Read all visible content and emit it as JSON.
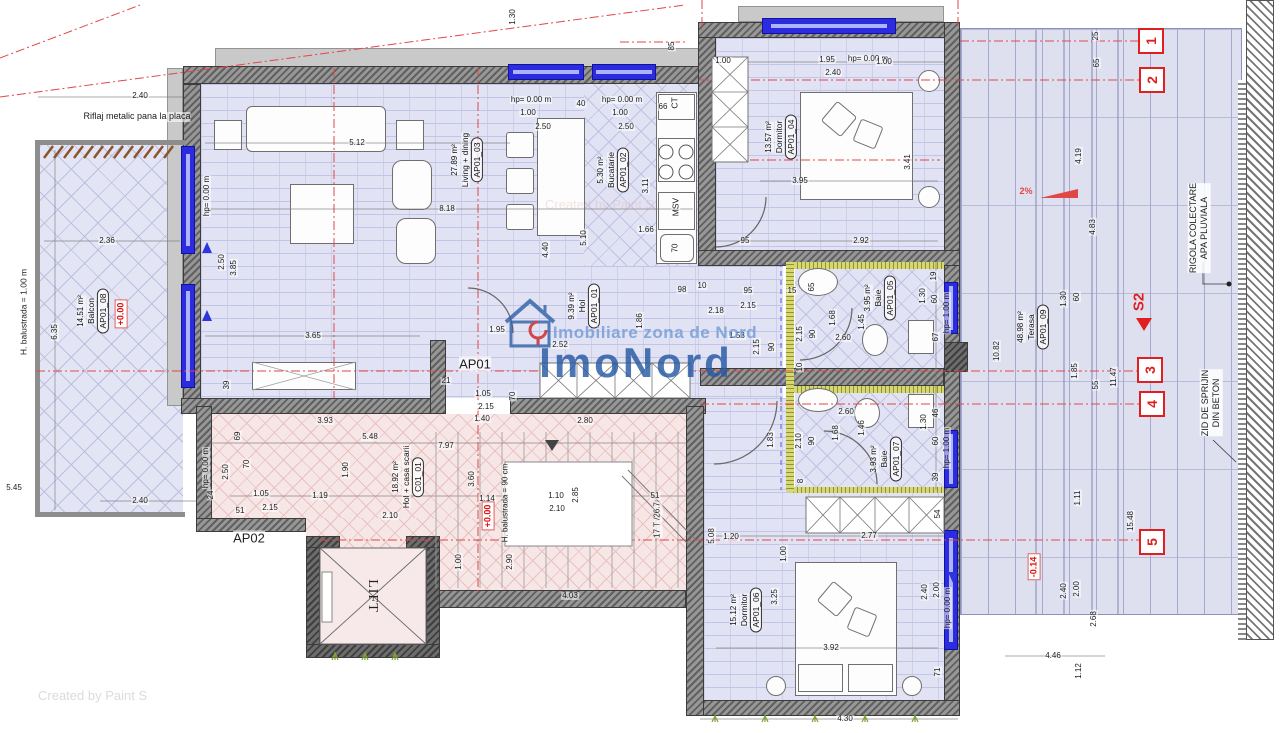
{
  "watermark": {
    "subtitle": "Imobiliare zona de Nord",
    "brand": "ImoNord",
    "credit": "Created by Paint S"
  },
  "unit_labels": {
    "ap01": "AP01",
    "ap02": "AP02",
    "lift": "LIFT"
  },
  "equipment": {
    "ct": "CT",
    "msv": "MSV",
    "sink": "70",
    "stairs_note": "17 T /26.7"
  },
  "notes": {
    "riflaj": "Riflaj metalic pana la placa",
    "balustrade_balcony": "H. balustrada = 1.00 m",
    "balustrade_stairs": "H. balustrada = 90 cm",
    "rigola_line1": "RIGOLA COLECTARE",
    "rigola_line2": "APA PLUVIALA",
    "zid_line1": "ZID DE SPRIJIN",
    "zid_line2": "DIN BETON",
    "slope": "2%",
    "section": "S2"
  },
  "levels": [
    {
      "t": "+0.00",
      "x": 121,
      "y": 314
    },
    {
      "t": "+0.00",
      "x": 488,
      "y": 516
    },
    {
      "t": "-0.14",
      "x": 1034,
      "y": 567
    }
  ],
  "grid_markers": [
    {
      "n": "1",
      "x": 1151,
      "y": 41
    },
    {
      "n": "2",
      "x": 1152,
      "y": 80
    },
    {
      "n": "3",
      "x": 1150,
      "y": 370
    },
    {
      "n": "4",
      "x": 1152,
      "y": 404
    },
    {
      "n": "5",
      "x": 1152,
      "y": 542
    }
  ],
  "rooms": [
    {
      "id": "AP01_03",
      "name": "Living + dining",
      "area": "27.89 m²",
      "x": 467,
      "y": 160
    },
    {
      "id": "AP01_02",
      "name": "Bucatarie",
      "area": "5.30 m²",
      "x": 613,
      "y": 170
    },
    {
      "id": "AP01_04",
      "name": "Dormitor",
      "area": "13.57 m²",
      "x": 781,
      "y": 137
    },
    {
      "id": "AP01_01",
      "name": "Hol",
      "area": "9.39 m²",
      "x": 584,
      "y": 306
    },
    {
      "id": "AP01_05",
      "name": "Baie",
      "area": "3.95 m²",
      "x": 880,
      "y": 298
    },
    {
      "id": "AP01_07",
      "name": "Baie",
      "area": "3.93 m²",
      "x": 886,
      "y": 459
    },
    {
      "id": "AP01_06",
      "name": "Dormitor",
      "area": "15.12 m²",
      "x": 746,
      "y": 610
    },
    {
      "id": "AP01_08",
      "name": "Balcon",
      "area": "14.51 m²",
      "x": 93,
      "y": 311
    },
    {
      "id": "AP01_09",
      "name": "Terasa",
      "area": "48.98 m²",
      "x": 1033,
      "y": 327
    },
    {
      "id": "C01_01",
      "name": "Hol + casa scarii",
      "area": "18.92 m²",
      "x": 408,
      "y": 477
    }
  ],
  "dimensions": [
    {
      "t": "2.40",
      "x": 140,
      "y": 96
    },
    {
      "t": "5.12",
      "x": 357,
      "y": 143
    },
    {
      "t": "1.30",
      "x": 513,
      "y": 17,
      "v": 1
    },
    {
      "t": "hp= 0.00 m",
      "x": 531,
      "y": 100
    },
    {
      "t": "1.00",
      "x": 528,
      "y": 113
    },
    {
      "t": "2.50",
      "x": 543,
      "y": 127
    },
    {
      "t": "40",
      "x": 581,
      "y": 104
    },
    {
      "t": "hp= 0.00 m",
      "x": 622,
      "y": 100
    },
    {
      "t": "1.00",
      "x": 620,
      "y": 113
    },
    {
      "t": "2.50",
      "x": 626,
      "y": 127
    },
    {
      "t": "66",
      "x": 663,
      "y": 107
    },
    {
      "t": "85",
      "x": 672,
      "y": 46,
      "v": 1
    },
    {
      "t": "1.00",
      "x": 723,
      "y": 61
    },
    {
      "t": "1.95",
      "x": 827,
      "y": 60
    },
    {
      "t": "hp= 0.00 m",
      "x": 868,
      "y": 59
    },
    {
      "t": "2.40",
      "x": 833,
      "y": 73
    },
    {
      "t": "1.00",
      "x": 884,
      "y": 62
    },
    {
      "t": "3.95",
      "x": 800,
      "y": 181
    },
    {
      "t": "3.41",
      "x": 908,
      "y": 162,
      "v": 1
    },
    {
      "t": "2.92",
      "x": 861,
      "y": 241
    },
    {
      "t": "95",
      "x": 745,
      "y": 241
    },
    {
      "t": "hp= 0.00 m",
      "x": 207,
      "y": 196,
      "v": 1
    },
    {
      "t": "8.18",
      "x": 447,
      "y": 209
    },
    {
      "t": "2.36",
      "x": 107,
      "y": 241
    },
    {
      "t": "2.50",
      "x": 222,
      "y": 262,
      "v": 1
    },
    {
      "t": "3.85",
      "x": 234,
      "y": 268,
      "v": 1
    },
    {
      "t": "5.10",
      "x": 584,
      "y": 238,
      "v": 1
    },
    {
      "t": "4.40",
      "x": 546,
      "y": 250,
      "v": 1
    },
    {
      "t": "3.11",
      "x": 646,
      "y": 186,
      "v": 1
    },
    {
      "t": "1.66",
      "x": 646,
      "y": 230
    },
    {
      "t": "3.65",
      "x": 313,
      "y": 336
    },
    {
      "t": "6.35",
      "x": 55,
      "y": 332,
      "v": 1
    },
    {
      "t": "39",
      "x": 227,
      "y": 385,
      "v": 1
    },
    {
      "t": "1.95",
      "x": 497,
      "y": 330
    },
    {
      "t": "2.52",
      "x": 560,
      "y": 345
    },
    {
      "t": "1.86",
      "x": 640,
      "y": 321,
      "v": 1
    },
    {
      "t": "98",
      "x": 682,
      "y": 290
    },
    {
      "t": "10",
      "x": 702,
      "y": 286
    },
    {
      "t": "95",
      "x": 748,
      "y": 291
    },
    {
      "t": "2.18",
      "x": 716,
      "y": 311
    },
    {
      "t": "2.15",
      "x": 748,
      "y": 306
    },
    {
      "t": "1.53",
      "x": 737,
      "y": 336
    },
    {
      "t": "15",
      "x": 792,
      "y": 291
    },
    {
      "t": "2.15",
      "x": 757,
      "y": 347,
      "v": 1
    },
    {
      "t": "90",
      "x": 772,
      "y": 347,
      "v": 1
    },
    {
      "t": "2.15",
      "x": 800,
      "y": 334,
      "v": 1
    },
    {
      "t": "90",
      "x": 813,
      "y": 334,
      "v": 1
    },
    {
      "t": "1.68",
      "x": 833,
      "y": 318,
      "v": 1
    },
    {
      "t": "2.60",
      "x": 843,
      "y": 338
    },
    {
      "t": "1.45",
      "x": 862,
      "y": 322,
      "v": 1
    },
    {
      "t": "65",
      "x": 812,
      "y": 287,
      "v": 1
    },
    {
      "t": "19",
      "x": 934,
      "y": 276,
      "v": 1
    },
    {
      "t": "1.30",
      "x": 923,
      "y": 296,
      "v": 1
    },
    {
      "t": "60",
      "x": 935,
      "y": 299,
      "v": 1
    },
    {
      "t": "67",
      "x": 936,
      "y": 337,
      "v": 1
    },
    {
      "t": "hp= 1.00 m",
      "x": 947,
      "y": 313,
      "v": 1
    },
    {
      "t": "10",
      "x": 800,
      "y": 367,
      "v": 1
    },
    {
      "t": "2.10",
      "x": 799,
      "y": 441,
      "v": 1
    },
    {
      "t": "90",
      "x": 812,
      "y": 441,
      "v": 1
    },
    {
      "t": "1.68",
      "x": 836,
      "y": 433,
      "v": 1
    },
    {
      "t": "2.60",
      "x": 846,
      "y": 412
    },
    {
      "t": "1.46",
      "x": 862,
      "y": 428,
      "v": 1
    },
    {
      "t": "1.83",
      "x": 771,
      "y": 440,
      "v": 1
    },
    {
      "t": "46",
      "x": 936,
      "y": 413,
      "v": 1
    },
    {
      "t": "1.30",
      "x": 924,
      "y": 422,
      "v": 1
    },
    {
      "t": "60",
      "x": 936,
      "y": 441,
      "v": 1
    },
    {
      "t": "39",
      "x": 936,
      "y": 477,
      "v": 1
    },
    {
      "t": "hp= 1.00 m",
      "x": 947,
      "y": 448,
      "v": 1
    },
    {
      "t": "8",
      "x": 801,
      "y": 481,
      "v": 1
    },
    {
      "t": "3.93",
      "x": 325,
      "y": 421
    },
    {
      "t": "5.48",
      "x": 370,
      "y": 437
    },
    {
      "t": "69",
      "x": 238,
      "y": 436,
      "v": 1
    },
    {
      "t": "70",
      "x": 247,
      "y": 464,
      "v": 1
    },
    {
      "t": "2.50",
      "x": 226,
      "y": 472,
      "v": 1
    },
    {
      "t": "hp= 0.00 m",
      "x": 206,
      "y": 468,
      "v": 1
    },
    {
      "t": "24",
      "x": 211,
      "y": 495,
      "v": 1
    },
    {
      "t": "51",
      "x": 240,
      "y": 511
    },
    {
      "t": "1.05",
      "x": 261,
      "y": 494
    },
    {
      "t": "2.15",
      "x": 270,
      "y": 508
    },
    {
      "t": "1.19",
      "x": 320,
      "y": 496
    },
    {
      "t": "1.90",
      "x": 346,
      "y": 470,
      "v": 1
    },
    {
      "t": "7.97",
      "x": 446,
      "y": 446
    },
    {
      "t": "1.40",
      "x": 482,
      "y": 419
    },
    {
      "t": "3.60",
      "x": 472,
      "y": 479,
      "v": 1
    },
    {
      "t": "1.14",
      "x": 487,
      "y": 499
    },
    {
      "t": "1.10",
      "x": 556,
      "y": 496
    },
    {
      "t": "2.10",
      "x": 557,
      "y": 509
    },
    {
      "t": "51",
      "x": 655,
      "y": 496
    },
    {
      "t": "21",
      "x": 446,
      "y": 381
    },
    {
      "t": "1.05",
      "x": 483,
      "y": 394
    },
    {
      "t": "2.15",
      "x": 486,
      "y": 407
    },
    {
      "t": "70",
      "x": 513,
      "y": 396,
      "v": 1
    },
    {
      "t": "2.80",
      "x": 585,
      "y": 421
    },
    {
      "t": "2.10",
      "x": 390,
      "y": 516
    },
    {
      "t": "1.00",
      "x": 459,
      "y": 562,
      "v": 1
    },
    {
      "t": "2.85",
      "x": 576,
      "y": 495,
      "v": 1
    },
    {
      "t": "2.90",
      "x": 510,
      "y": 562,
      "v": 1
    },
    {
      "t": "4.03",
      "x": 570,
      "y": 596
    },
    {
      "t": "1.00",
      "x": 784,
      "y": 554,
      "v": 1
    },
    {
      "t": "5.08",
      "x": 712,
      "y": 536,
      "v": 1
    },
    {
      "t": "1.20",
      "x": 731,
      "y": 537
    },
    {
      "t": "2.77",
      "x": 869,
      "y": 536
    },
    {
      "t": "54",
      "x": 938,
      "y": 514,
      "v": 1
    },
    {
      "t": "3.25",
      "x": 775,
      "y": 597,
      "v": 1
    },
    {
      "t": "3.92",
      "x": 831,
      "y": 648
    },
    {
      "t": "2.40",
      "x": 925,
      "y": 592,
      "v": 1
    },
    {
      "t": "2.00",
      "x": 937,
      "y": 590,
      "v": 1
    },
    {
      "t": "hp= 0.00 m",
      "x": 948,
      "y": 608,
      "v": 1
    },
    {
      "t": "71",
      "x": 938,
      "y": 672,
      "v": 1
    },
    {
      "t": "4.30",
      "x": 845,
      "y": 719
    },
    {
      "t": "2.40",
      "x": 140,
      "y": 501
    },
    {
      "t": "5.45",
      "x": 14,
      "y": 488
    },
    {
      "t": "25",
      "x": 1096,
      "y": 36,
      "v": 1
    },
    {
      "t": "65",
      "x": 1097,
      "y": 63,
      "v": 1
    },
    {
      "t": "4.19",
      "x": 1079,
      "y": 156,
      "v": 1
    },
    {
      "t": "4.83",
      "x": 1093,
      "y": 227,
      "v": 1
    },
    {
      "t": "1.30",
      "x": 1064,
      "y": 299,
      "v": 1
    },
    {
      "t": "60",
      "x": 1077,
      "y": 297,
      "v": 1
    },
    {
      "t": "10.82",
      "x": 997,
      "y": 351,
      "v": 1
    },
    {
      "t": "1.85",
      "x": 1075,
      "y": 371,
      "v": 1
    },
    {
      "t": "55",
      "x": 1096,
      "y": 385,
      "v": 1
    },
    {
      "t": "11.47",
      "x": 1114,
      "y": 377,
      "v": 1
    },
    {
      "t": "15.48",
      "x": 1131,
      "y": 521,
      "v": 1
    },
    {
      "t": "1.11",
      "x": 1078,
      "y": 498,
      "v": 1
    },
    {
      "t": "2.40",
      "x": 1064,
      "y": 591,
      "v": 1
    },
    {
      "t": "2.00",
      "x": 1077,
      "y": 589,
      "v": 1
    },
    {
      "t": "2.68",
      "x": 1094,
      "y": 619,
      "v": 1
    },
    {
      "t": "1.12",
      "x": 1079,
      "y": 671,
      "v": 1
    },
    {
      "t": "4.46",
      "x": 1053,
      "y": 656
    }
  ]
}
